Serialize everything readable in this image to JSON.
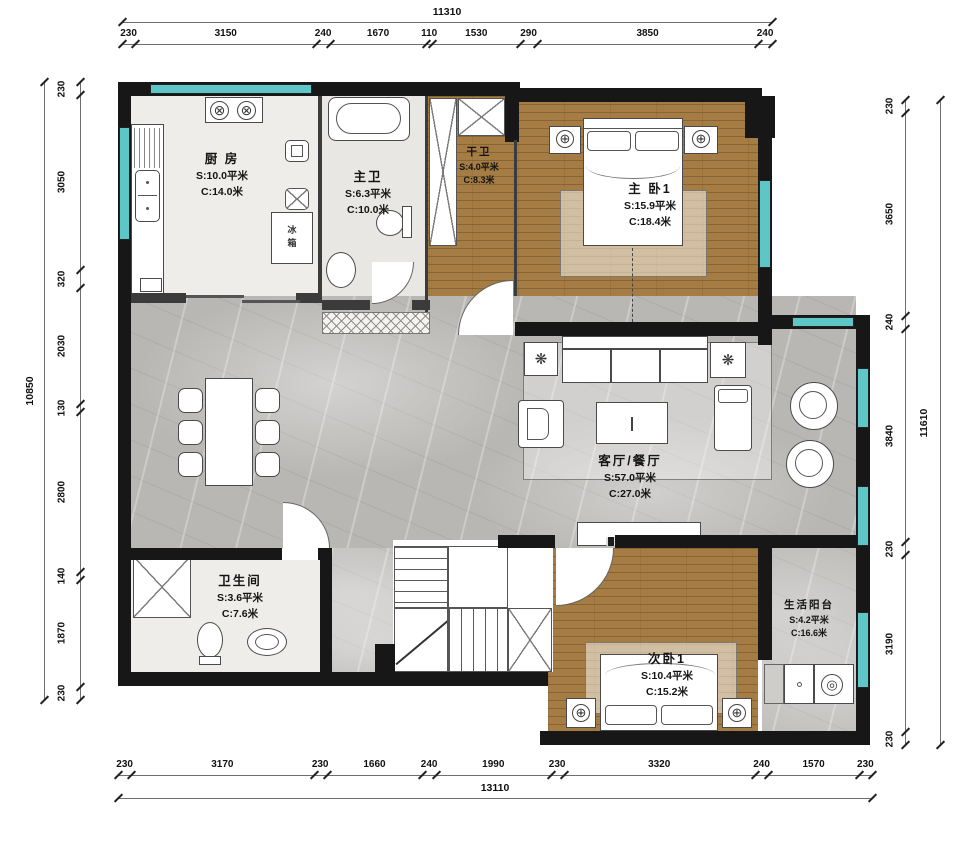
{
  "rooms": {
    "kitchen": {
      "name": "厨 房",
      "area": "S:10.0平米",
      "perimeter": "C:14.0米"
    },
    "master_bath": {
      "name": "主卫",
      "area": "S:6.3平米",
      "perimeter": "C:10.0米"
    },
    "dry_bath": {
      "name": "干卫",
      "area": "S:4.0平米",
      "perimeter": "C:8.3米"
    },
    "master_bedroom": {
      "name": "主 卧1",
      "area": "S:15.9平米",
      "perimeter": "C:18.4米"
    },
    "living_dining": {
      "name": "客厅/餐厅",
      "area": "S:57.0平米",
      "perimeter": "C:27.0米"
    },
    "bathroom": {
      "name": "卫生间",
      "area": "S:3.6平米",
      "perimeter": "C:7.6米"
    },
    "second_bedroom": {
      "name": "次卧1",
      "area": "S:10.4平米",
      "perimeter": "C:15.2米"
    },
    "balcony": {
      "name": "生活阳台",
      "area": "S:4.2平米",
      "perimeter": "C:16.6米"
    }
  },
  "appliances": {
    "fridge": "冰箱"
  },
  "icons": {
    "burner": "⊗",
    "lamp": "⊕",
    "plant": "❋",
    "washer_door": "◎",
    "drain": "◎"
  },
  "dimensions": {
    "top": {
      "total": "11310",
      "segments": [
        "230",
        "3150",
        "240",
        "1670",
        "110",
        "1530",
        "290",
        "3850",
        "240"
      ]
    },
    "bottom": {
      "total": "13110",
      "segments": [
        "230",
        "3170",
        "230",
        "1660",
        "240",
        "1990",
        "230",
        "3320",
        "240",
        "1570",
        "230"
      ]
    },
    "left": {
      "total": "10850",
      "segments": [
        "230",
        "3050",
        "320",
        "2030",
        "130",
        "2800",
        "140",
        "1870",
        "230"
      ]
    },
    "right": {
      "total": "11610",
      "segments": [
        "230",
        "3650",
        "240",
        "3840",
        "230",
        "3190",
        "230"
      ]
    }
  },
  "colors": {
    "wall": "#171717",
    "window": "#5fc6c8",
    "wood_floor": "#a57c43",
    "marble_floor": "#b9b7b4"
  }
}
